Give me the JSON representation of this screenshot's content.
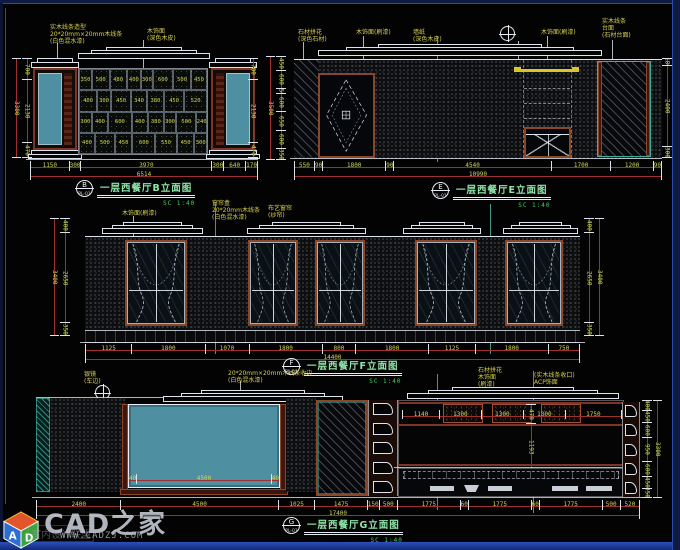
{
  "colors": {
    "teal_panel": "#4e8fa2",
    "maroon": "#7c3328",
    "dim_text": "#ccd659",
    "annotation_yellow": "#d8d04e",
    "title_green": "#8fe6a8",
    "scale_green": "#3ecf5a",
    "highlight_yellow": "#d8c62a",
    "cut_teal": "#3fae9f"
  },
  "watermark": {
    "brand": "CAD之家",
    "site": "WWW.CADZJ.COM",
    "alliance": "室内设计联盟",
    "cube_front": "A",
    "cube_side": "D"
  },
  "titles": {
    "B": {
      "bubble": "B",
      "ref": "PL-01",
      "text": "一层西餐厅B立面图",
      "scale": "SC 1:40"
    },
    "E": {
      "bubble": "E",
      "ref": "PL-01",
      "text": "一层西餐厅E立面图",
      "scale": "SC 1:40"
    },
    "F": {
      "bubble": "F",
      "ref": "PL-01",
      "text": "一层西餐厅F立面图",
      "scale": "SC 1:40"
    },
    "G": {
      "bubble": "G",
      "ref": "PL-01",
      "text": "一层西餐厅G立面图",
      "scale": "SC 1:40"
    }
  },
  "drawings": {
    "B": {
      "annotations": [
        "实木线条造型",
        "20*20mm×20mm木线条",
        "(白色混水漆)",
        "木饰面",
        "(深色木皮)"
      ],
      "rack_rows": [
        [
          "350",
          "500",
          "480",
          "400",
          "300",
          "600",
          "500",
          "450"
        ],
        [
          "400",
          "300",
          "450",
          "340",
          "380",
          "450",
          "520"
        ],
        [
          "300",
          "400",
          "600",
          "400",
          "380",
          "300",
          "500",
          "240"
        ],
        [
          "400",
          "500",
          "450",
          "600",
          "550",
          "450",
          "300"
        ]
      ],
      "left_dims": [
        "700",
        "2130",
        "470"
      ],
      "left_total": "3300",
      "right_dims": [
        "700",
        "2130",
        "470"
      ],
      "bottom_dims": [
        "1150",
        "300",
        "3970",
        "300",
        "640",
        "170"
      ],
      "bottom_total": "6514"
    },
    "E": {
      "annotations": [
        "石材拼花",
        "(深色石材)",
        "木饰面(刷漆)",
        "墙纸",
        "(深色木皮)",
        "木饰面(刷漆)",
        "实木线条",
        "台面",
        "(石材台面)"
      ],
      "left_dims": [
        "450",
        "600",
        "150",
        "600",
        "650",
        "600",
        "350"
      ],
      "left_total": "3500",
      "right_dims": [
        "180",
        "2400",
        "300"
      ],
      "bottom_dims": [
        "550",
        "90",
        "1800",
        "90",
        "4540",
        "1700",
        "1200",
        "90"
      ],
      "bottom_total": "10990"
    },
    "F": {
      "annotations": [
        "木饰面(刷漆)",
        "窗帘盒",
        "20*20mm木线条",
        "(白色混水漆)",
        "布艺窗帘",
        "(纱帘)"
      ],
      "left_dims": [
        "400",
        "2650",
        "350"
      ],
      "left_total": "3400",
      "right_dims": [
        "400",
        "2650",
        "350"
      ],
      "right_total": "3400",
      "bottom_dims": [
        "1125",
        "1800",
        "1070",
        "1800",
        "800",
        "1800",
        "1125",
        "1800",
        "750"
      ],
      "bottom_total": "14400"
    },
    "G": {
      "annotations": [
        "银镜",
        "(车边)",
        "20*20mm×20mm木线条收边",
        "(白色混水漆)",
        "石材拼花",
        "木饰面",
        "(刷漆)",
        "(实木线条收口)",
        "ACP饰面"
      ],
      "panel_dims": [
        "1140",
        "1300",
        "1300",
        "1300",
        "1750"
      ],
      "mid_dims": [
        "470",
        "1193",
        "150",
        "420"
      ],
      "mirror_dims": [
        "40",
        "4500",
        "40"
      ],
      "right_dims": [
        "400",
        "450",
        "600",
        "950",
        "600",
        "450",
        "350"
      ],
      "right_total": "3300",
      "bottom_dims": [
        "2400",
        "4500",
        "1025",
        "1475",
        "150",
        "500",
        "1775",
        "60",
        "1775",
        "60",
        "1775",
        "500",
        "520"
      ],
      "bottom_total": "17400"
    }
  }
}
